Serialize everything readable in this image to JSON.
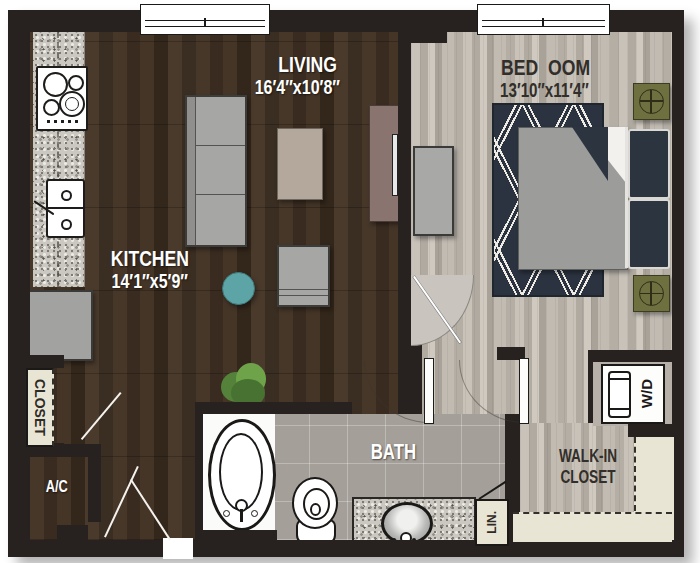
{
  "floorplan": {
    "rooms": {
      "living": {
        "name": "LIVING",
        "dims": "16\u20324\u2033x10\u20328\u2033"
      },
      "kitchen": {
        "name": "KITCHEN",
        "dims": "14\u20321\u2033x5\u20329\u2033"
      },
      "bedroom": {
        "name": "BED\u00a0\u00a0OOM",
        "dims": "13\u203210\u2033x11\u20324\u2033"
      },
      "bath": {
        "name": "BATH"
      },
      "walk_in": {
        "name": "WALK-IN CLOSET"
      },
      "closet": {
        "name": "CLOSET"
      },
      "ac": {
        "name": "A/C"
      },
      "linen": {
        "name": "LIN."
      },
      "wd": {
        "name": "W/D"
      }
    },
    "colors": {
      "wall": "#272220",
      "wood_dark": "#3e3025",
      "wood_light": "#bcb6ad",
      "bath_tile": "#a49f99",
      "rug_navy": "#2b3340",
      "accent_teal": "#5da4a6",
      "nightstand_olive": "#6f7040",
      "shelf_cream": "#e9e5d4",
      "tv_console_mauve": "#8a7470"
    },
    "icons": [
      "window",
      "door-swing",
      "cooktop",
      "kitchen-sink",
      "fridge",
      "sofa",
      "coffee-table",
      "armchair",
      "side-table",
      "tv-console",
      "tv",
      "plant",
      "dresser",
      "bed",
      "pillow",
      "nightstand-crosshair",
      "rug",
      "bathtub",
      "toilet",
      "vanity-sink",
      "washer-dryer"
    ]
  }
}
